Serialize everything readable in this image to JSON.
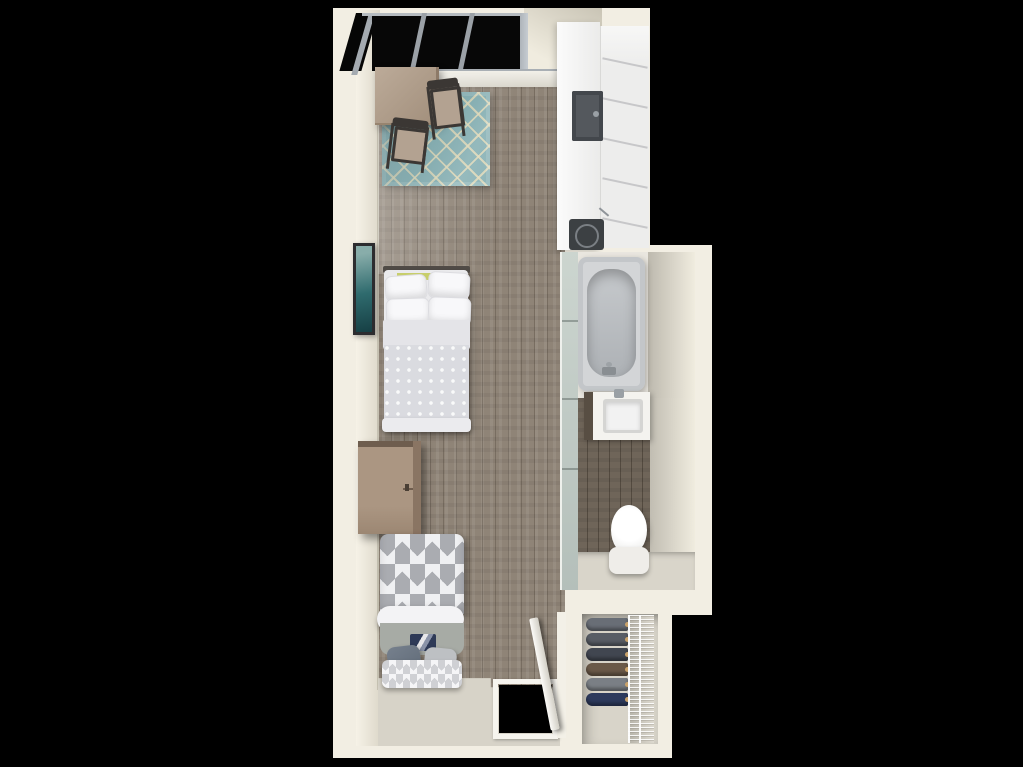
{
  "scene": {
    "description": "3D top-down floor plan rendering of a narrow studio apartment unit on a black background",
    "background": "#000000"
  },
  "palette": {
    "wall": "#f2eee3",
    "wallShade": "#d4cfbf",
    "floorWood": "#8f8477",
    "floorWoodDark": "#6f6559",
    "entryFloor": "#d7d3c8",
    "rugTeal": "#78a7ab",
    "rugLattice": "#d9d0ab",
    "counterWhite": "#f3f3f2",
    "applianceDark": "#3c4043",
    "steelGray": "#9ba1a7",
    "tubGray": "#d3d5d7",
    "tubBasin": "#b0b4b8",
    "frostedGlass": "#c4cec8",
    "fixtureWhite": "#f4f3ef",
    "tableTan": "#b3a291",
    "chairDark": "#3b3734",
    "dresserBrown": "#a08b77",
    "artTeal": "#2f6b6e",
    "beddingWhite": "#eaeaec",
    "beddingGray": "#d9dade",
    "blanketSage": "#a7aba5",
    "pillowSlate": "#5d6875",
    "accentNavy": "#2e3a57",
    "accentGreen": "#c7ce6b",
    "closetFloor": "#d8d4c9",
    "woodDoor": "#f6f4ee",
    "hangerGold": "#c9a26a"
  },
  "closet": {
    "clothes_colors": [
      "#696e76",
      "#585d65",
      "#414650",
      "#6a5948",
      "#7a7f85",
      "#2d3a5c"
    ]
  },
  "elements": [
    "window",
    "dining-table",
    "dining-chair",
    "area-rug",
    "kitchen-counter",
    "kitchen-sink",
    "cooktop",
    "tall-cabinet",
    "bathtub",
    "glass-partition",
    "bathroom-vanity",
    "vanity-sink",
    "toilet",
    "bed-1",
    "bed-2",
    "dresser",
    "wall-art",
    "closet",
    "wire-shelving",
    "hanging-clothes",
    "entry-door",
    "doorway"
  ]
}
